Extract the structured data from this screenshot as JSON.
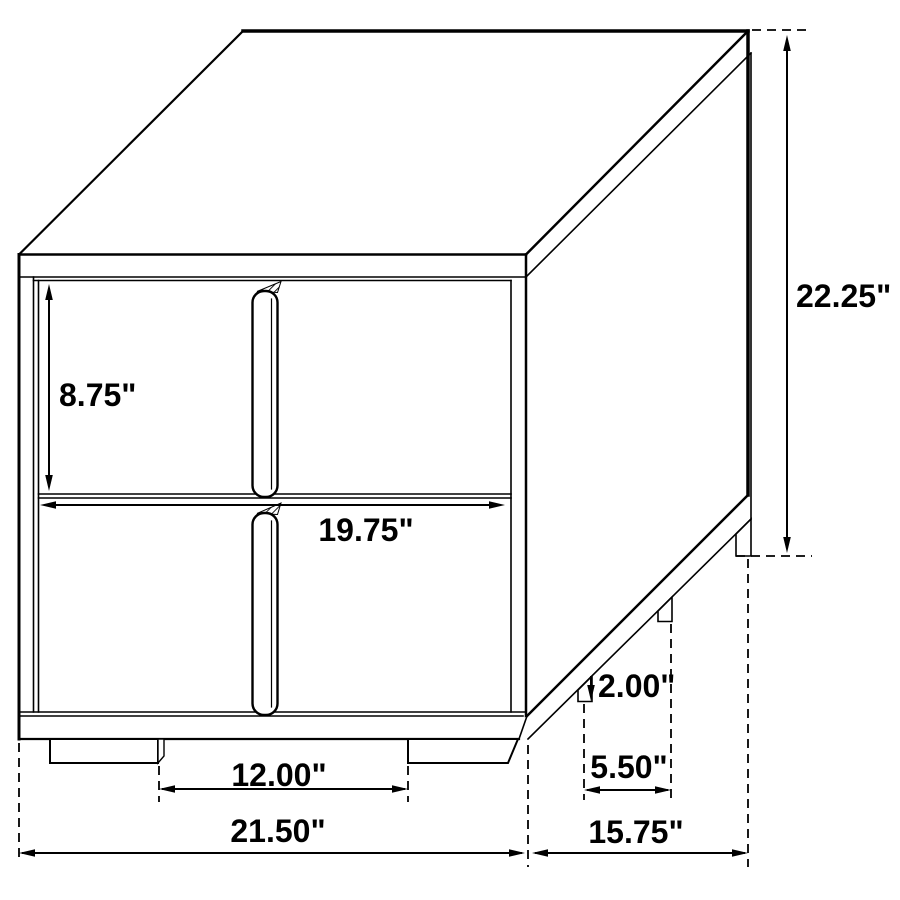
{
  "drawing": {
    "subject": "two-drawer nightstand dimension line drawing",
    "view": "oblique 3D line art",
    "background_color": "#ffffff",
    "line_color": "#000000",
    "text_color": "#000000",
    "unit": "inches"
  },
  "dimensions": {
    "total_height": {
      "label": "22.25\"",
      "value": 22.25,
      "measures": "overall height, top to floor"
    },
    "drawer_height": {
      "label": "8.75\"",
      "value": 8.75,
      "measures": "drawer front height"
    },
    "drawer_width": {
      "label": "19.75\"",
      "value": 19.75,
      "measures": "drawer opening width"
    },
    "leg_height": {
      "label": "2.00\"",
      "value": 2.0,
      "measures": "leg / foot height"
    },
    "side_leg_spacing": {
      "label": "5.50\"",
      "value": 5.5,
      "measures": "spacing between side legs"
    },
    "front_leg_spacing": {
      "label": "12.00\"",
      "value": 12.0,
      "measures": "spacing between front feet"
    },
    "total_width": {
      "label": "21.50\"",
      "value": 21.5,
      "measures": "overall width"
    },
    "total_depth": {
      "label": "15.75\"",
      "value": 15.75,
      "measures": "overall depth"
    }
  }
}
